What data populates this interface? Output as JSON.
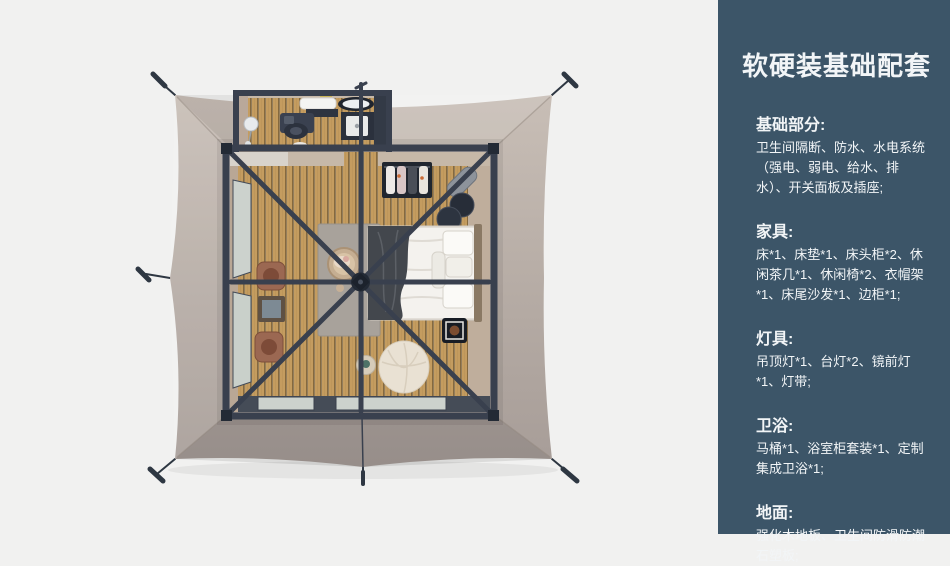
{
  "sidebar": {
    "title": "软硬装基础配套",
    "sections": [
      {
        "heading": "基础部分:",
        "body": "卫生间隔断、防水、水电系统（强电、弱电、给水、排水）、开关面板及插座;"
      },
      {
        "heading": "家具:",
        "body": "床*1、床垫*1、床头柜*2、休闲茶几*1、休闲椅*2、衣帽架*1、床尾沙发*1、边柜*1;"
      },
      {
        "heading": "灯具:",
        "body": "吊顶灯*1、台灯*2、镜前灯*1、灯带;"
      },
      {
        "heading": "卫浴:",
        "body": "马桶*1、浴室柜套装*1、定制集成卫浴*1;"
      },
      {
        "heading": "地面:",
        "body": "强化木地板、卫生间防滑防潮石塑板;"
      }
    ]
  },
  "illustration": {
    "description": "top-down 3d render of a square glamping tent: taupe canvas with guy lines, dark metal frame with radial roof beams, bathroom annex at top, wood plank floor, bed, wardrobe rack, leisure chairs, bean bag pouf"
  },
  "palette": {
    "background": "#f1f1f0",
    "sidebar_bg": "#3c5568",
    "sidebar_text": "#f2f5f7",
    "canvas_light": "#c8beb6",
    "canvas_dark": "#a79d98",
    "frame": "#39404e",
    "frame_dark": "#232a35",
    "wood": "#c49c5f",
    "wood_groove": "#7a6138",
    "wall_tan": "#b9a795",
    "wall_tan_light": "#c6b8a8",
    "rug": "#a8a29b",
    "window": "#ccd2cd",
    "bedding": "#f4f2ee",
    "throw": "#43474d",
    "chair": "#9b6852",
    "pouf": "#e9e1d3",
    "stake": "#2e3742"
  }
}
